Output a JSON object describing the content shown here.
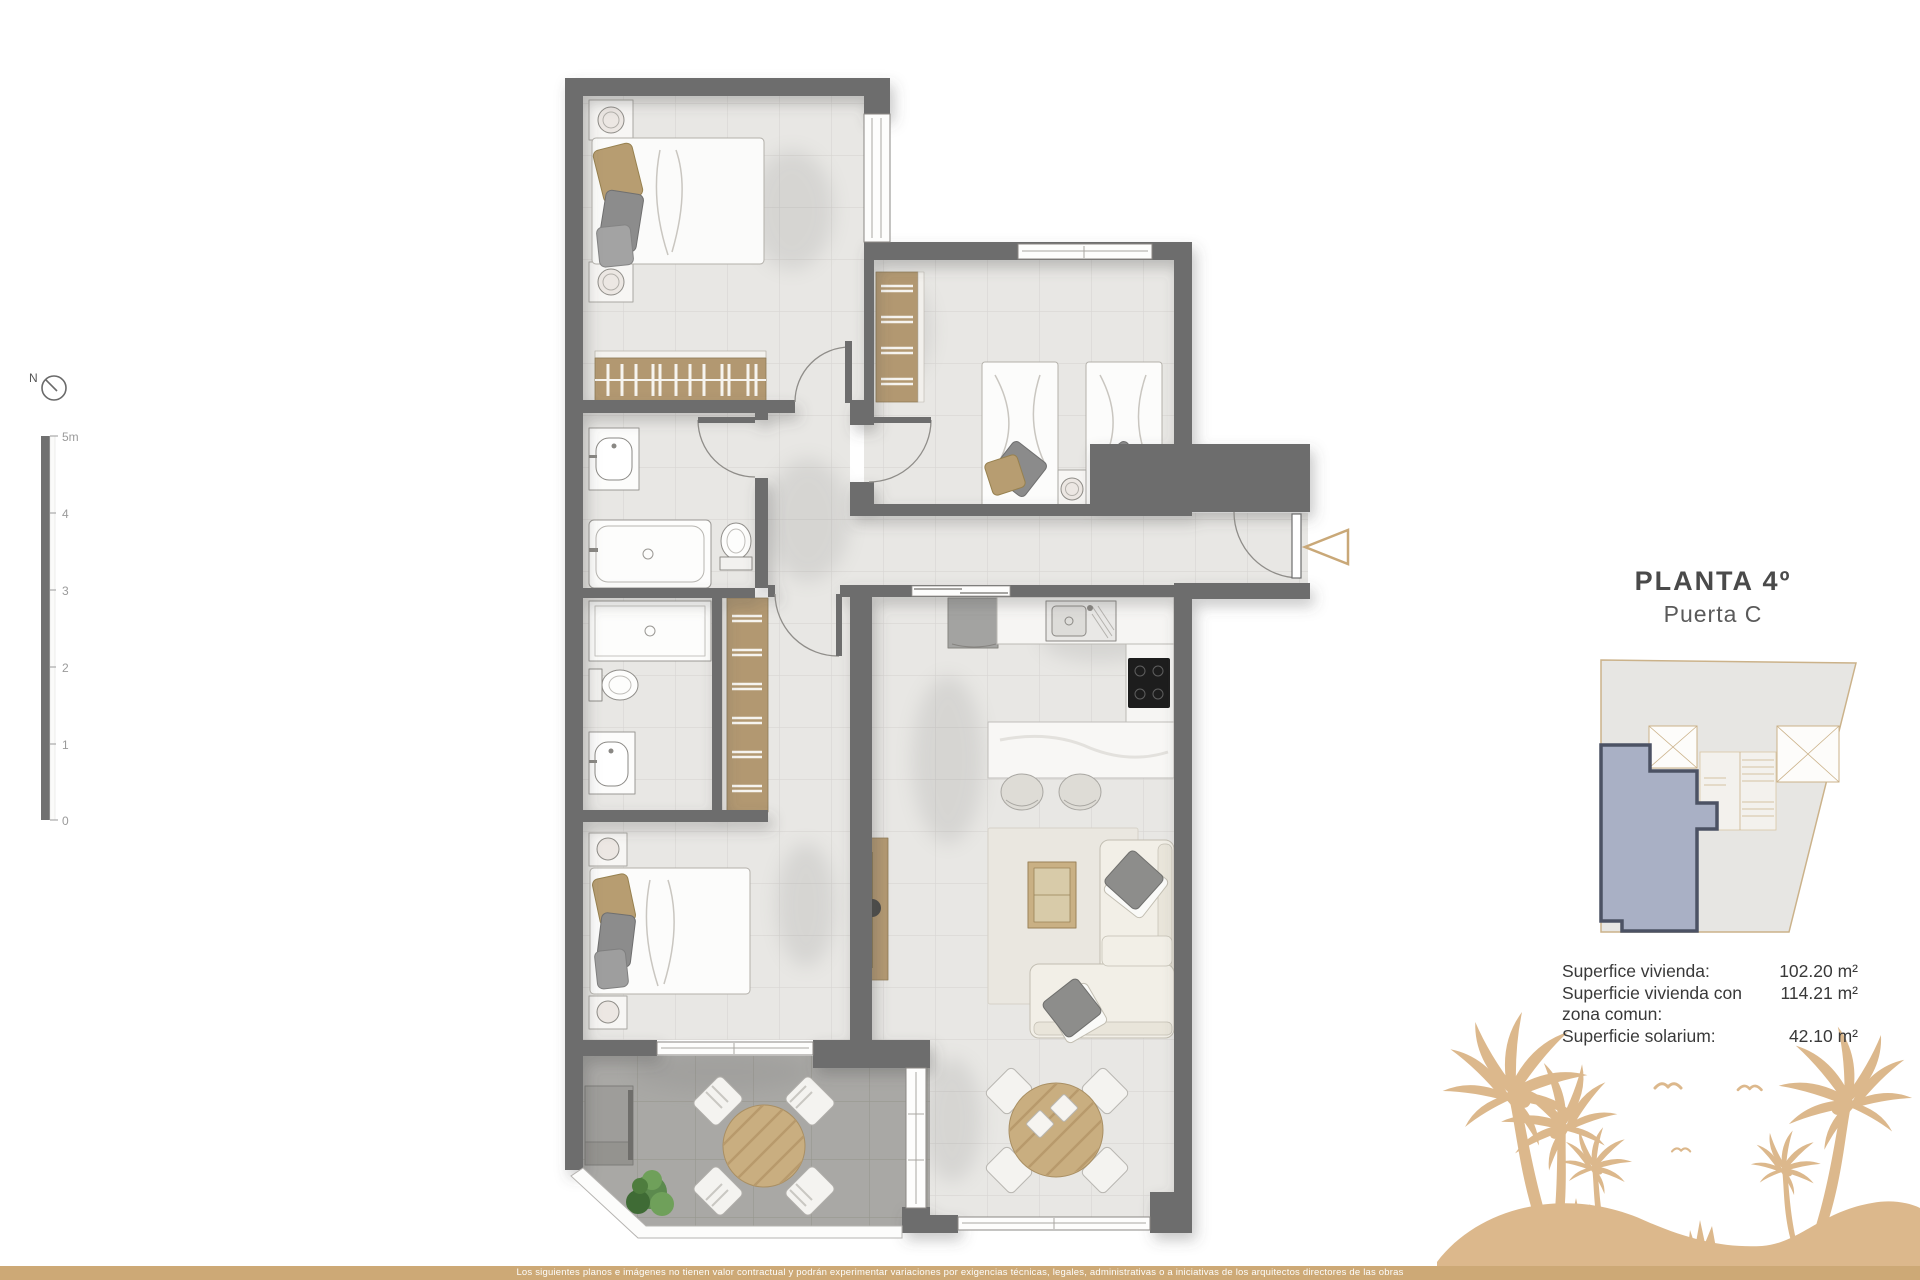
{
  "title": {
    "floor": "PLANTA 4º",
    "door": "Puerta C"
  },
  "areas": [
    {
      "label": "Superfice vivienda:",
      "value": "102.20 m²"
    },
    {
      "label": "Superficie vivienda con zona comun:",
      "value": "114.21 m²"
    },
    {
      "label": "Superficie solarium:",
      "value": "42.10 m²"
    }
  ],
  "scale_bar": {
    "ticks": [
      "5m",
      "4",
      "3",
      "2",
      "1",
      "0"
    ]
  },
  "compass": {
    "label": "N"
  },
  "footer": {
    "disclaimer": "Los siguientes planos e imágenes no tienen valor contractual y podrán experimentar variaciones por exigencias técnicas, legales, administrativas o a iniciativas de los arquitectos directores de las obras"
  },
  "colors": {
    "wall_gray": "#6d6d6d",
    "floor_tile": "#e8e7e4",
    "terrace_tile": "#a9a8a5",
    "wood_tan": "#b29871",
    "accent_tan": "#cda976",
    "palm_tan": "#dcb88c",
    "unit_highlight": "#a9b0c5",
    "unit_border": "#4c5264",
    "map_building": "#e7e6e3",
    "map_outline": "#cbb28a"
  }
}
